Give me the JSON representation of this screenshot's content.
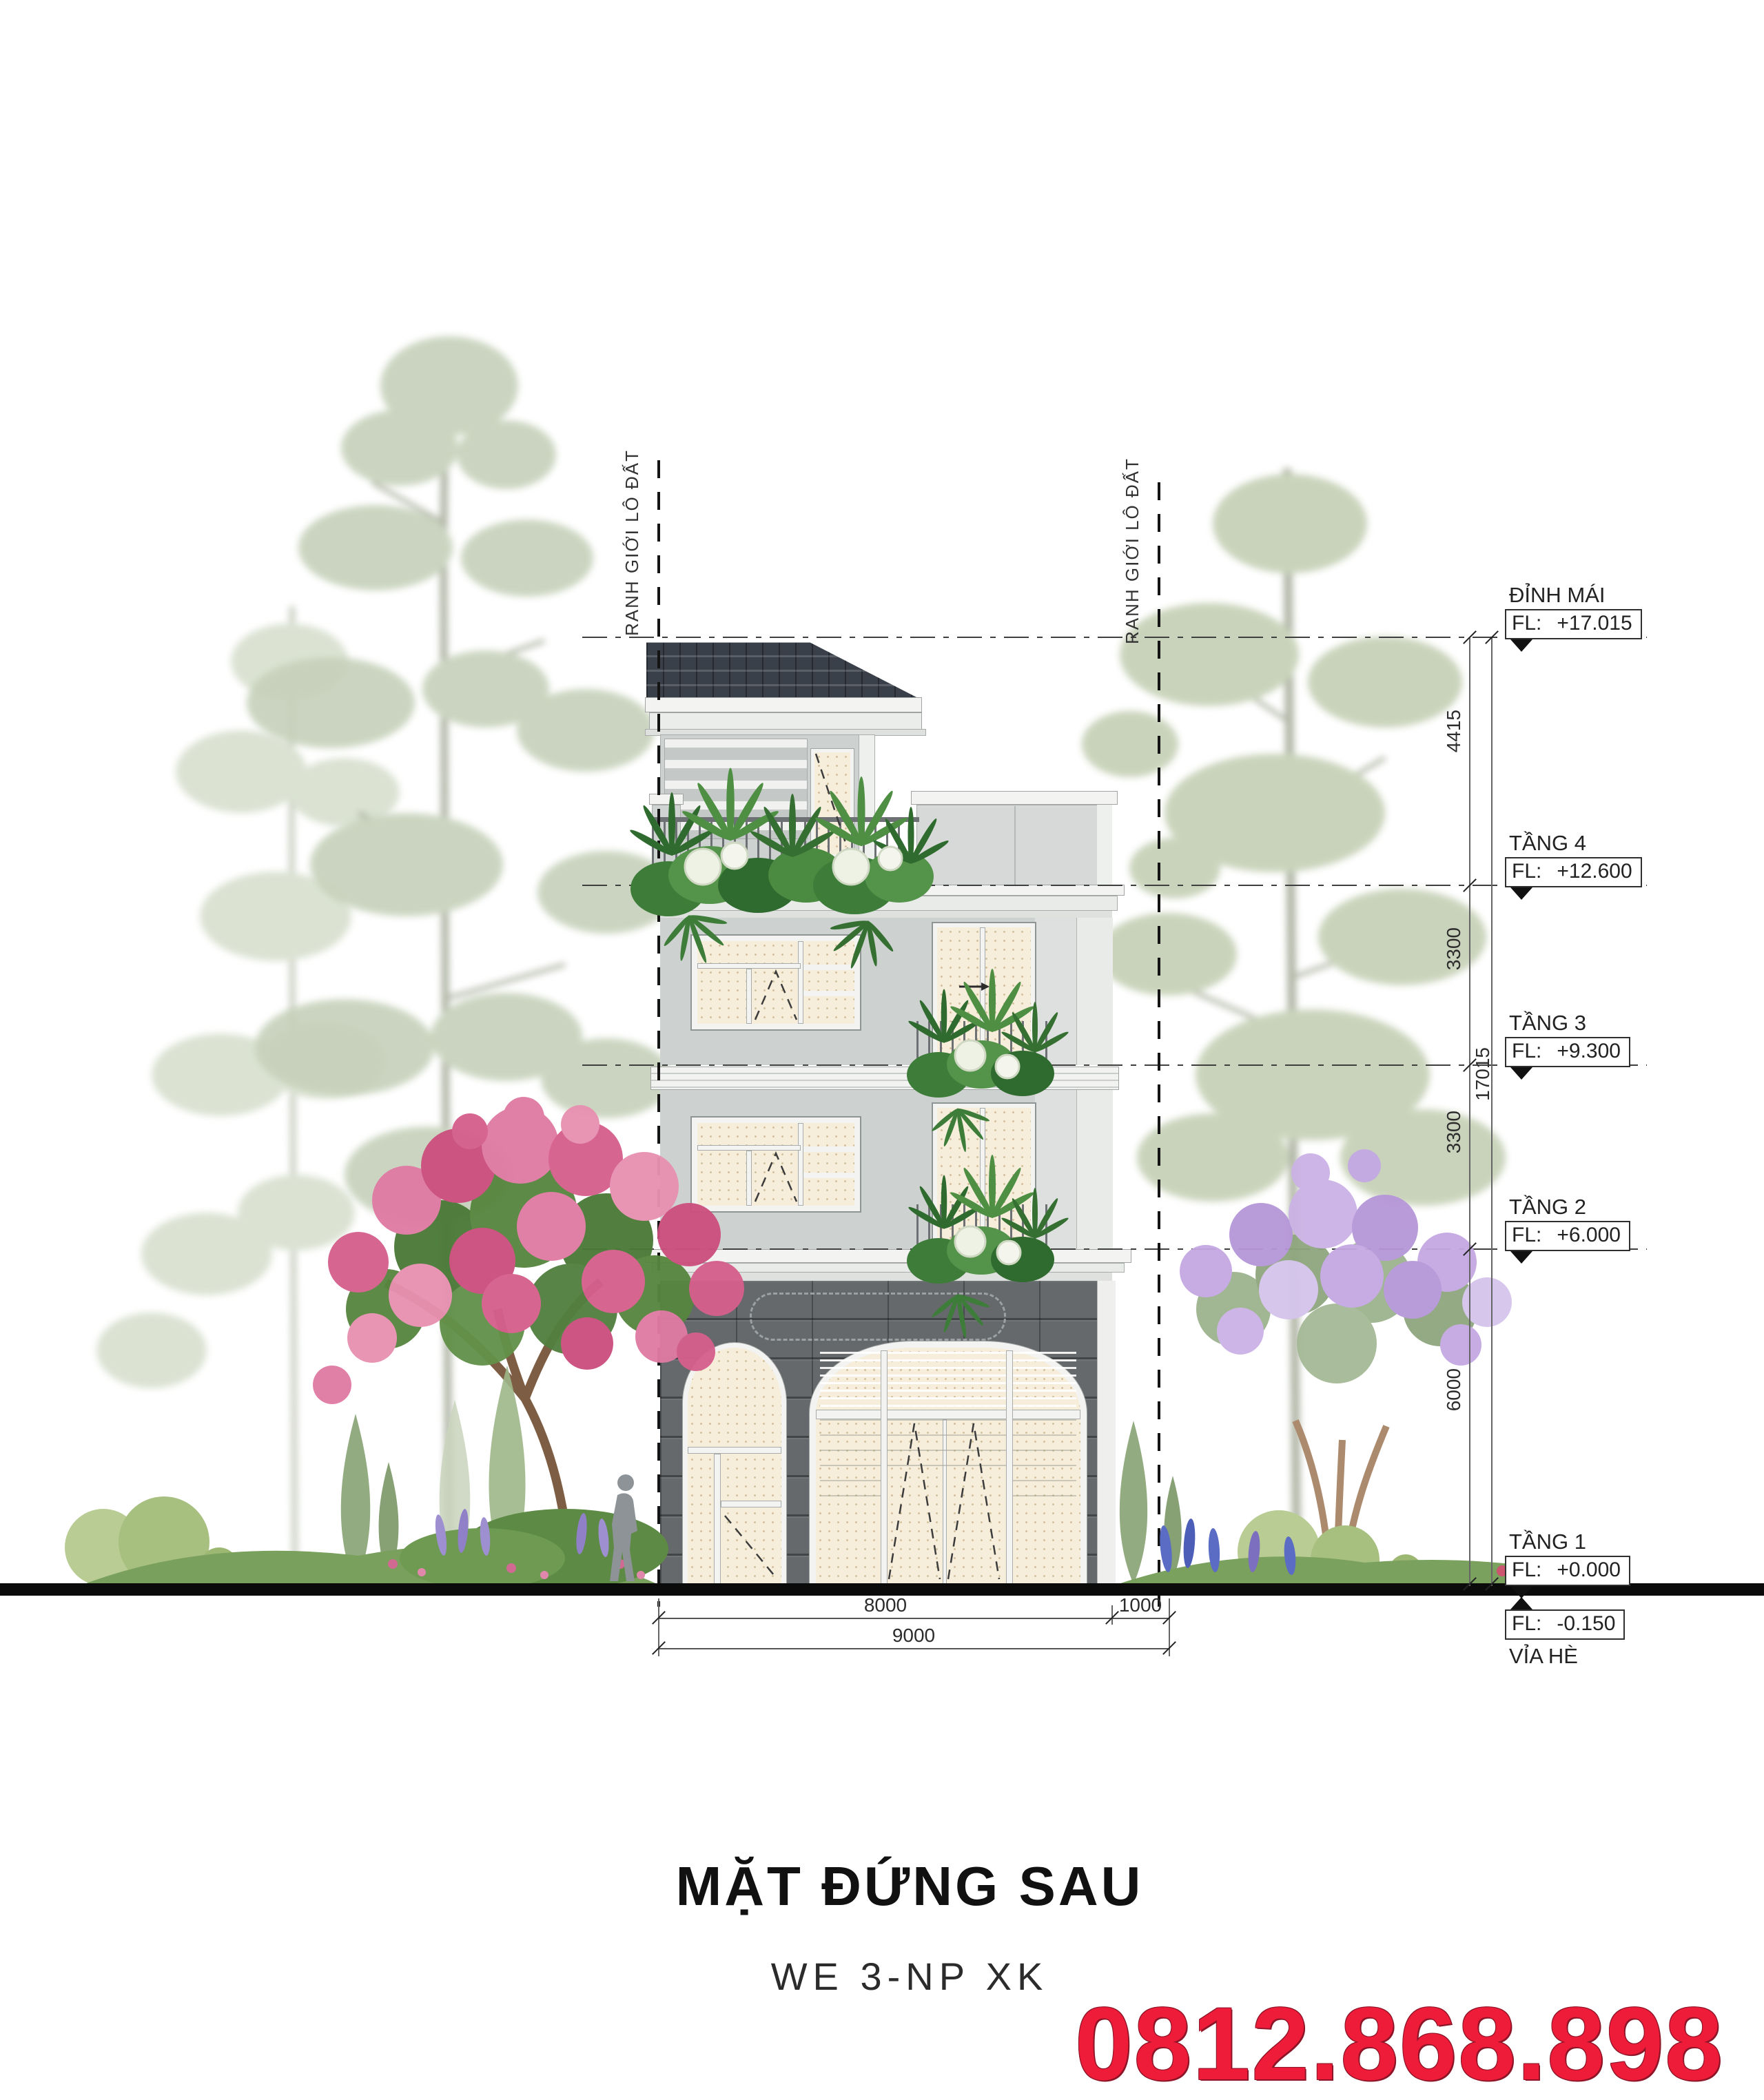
{
  "title": {
    "main": "MẶT ĐỨNG SAU",
    "code": "WE 3-NP XK",
    "phone": "0812.868.898"
  },
  "boundaries": {
    "left": "RANH GIỚI LÔ ĐẤT",
    "right": "RANH GIỚI LÔ ĐẤT"
  },
  "levels": [
    {
      "name": "ĐỈNH MÁI",
      "fl": "FL:",
      "value": "+17.015"
    },
    {
      "name": "TẦNG 4",
      "fl": "FL:",
      "value": "+12.600"
    },
    {
      "name": "TẦNG 3",
      "fl": "FL:",
      "value": "+9.300"
    },
    {
      "name": "TẦNG 2",
      "fl": "FL:",
      "value": "+6.000"
    },
    {
      "name": "TẦNG 1",
      "fl": "FL:",
      "value": "+0.000"
    },
    {
      "name": "VỈA HÈ",
      "fl": "FL:",
      "value": "-0.150"
    }
  ],
  "dimensions": {
    "vertical": [
      "4415",
      "3300",
      "3300",
      "6000"
    ],
    "total_vertical": "17015",
    "horizontal": [
      "8000",
      "1000"
    ],
    "total_horizontal": "9000"
  },
  "colors": {
    "accent_red": "#ee1b39",
    "roof": "#394049",
    "stone": "#65696c",
    "wall": "#cdd1cf",
    "glass": "#f6eedb"
  }
}
